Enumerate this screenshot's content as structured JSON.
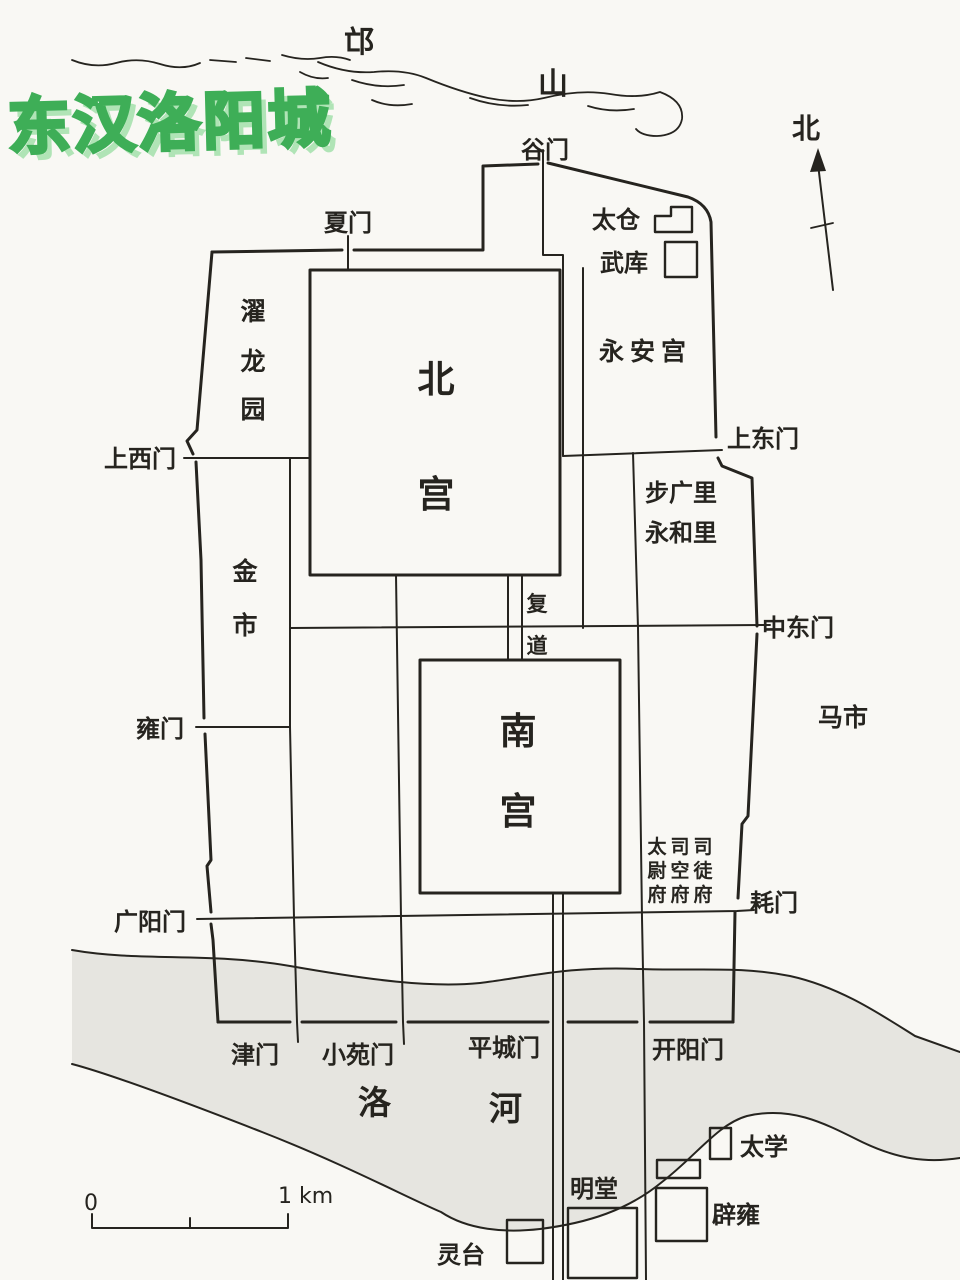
{
  "title": "东汉洛阳城",
  "compass": {
    "north": "北"
  },
  "mountain": {
    "char_mang": "邙",
    "char_shan": "山"
  },
  "river": {
    "char_luo": "洛",
    "char_he": "河"
  },
  "scale_bar": {
    "zero": "0",
    "one_km": "1 km"
  },
  "palaces": {
    "north_palace": [
      "北",
      "宫"
    ],
    "south_palace": [
      "南",
      "宫"
    ],
    "yongan_palace": "永安宫"
  },
  "gates": {
    "gu_men": "谷门",
    "xia_men": "夏门",
    "shangxi_men": "上西门",
    "shangdong_men": "上东门",
    "zhongdong_men": "中东门",
    "yong_men": "雍门",
    "guangyang_men": "广阳门",
    "hao_men": "耗门",
    "jin_men": "津门",
    "xiaoyuan_men": "小苑门",
    "pingcheng_men": "平城门",
    "kaiyang_men": "开阳门"
  },
  "districts": {
    "zhuolong_garden": [
      "濯",
      "龙",
      "园"
    ],
    "gold_market": [
      "金",
      "市"
    ],
    "horse_market": "马市",
    "buguang_li": "步广里",
    "yonghe_li": "永和里",
    "fudao": [
      "复",
      "道"
    ]
  },
  "offices": {
    "taiwei_fu": [
      "太",
      "尉",
      "府"
    ],
    "sikong_fu": [
      "司",
      "空",
      "府"
    ],
    "situ_fu": [
      "司",
      "徒",
      "府"
    ]
  },
  "buildings": {
    "taicang": "太仓",
    "wuku": "武库",
    "taixue": "太学",
    "biyong": "辟雍",
    "mingtang": "明堂",
    "lingtai": "灵台"
  },
  "colors": {
    "ink": "#26241f",
    "paper": "#f9f8f4",
    "river_fill": "#d7d5d0",
    "title_fill": "#ffffff",
    "title_outline": "#3eae57",
    "title_shadow": "#b0e4b6"
  }
}
